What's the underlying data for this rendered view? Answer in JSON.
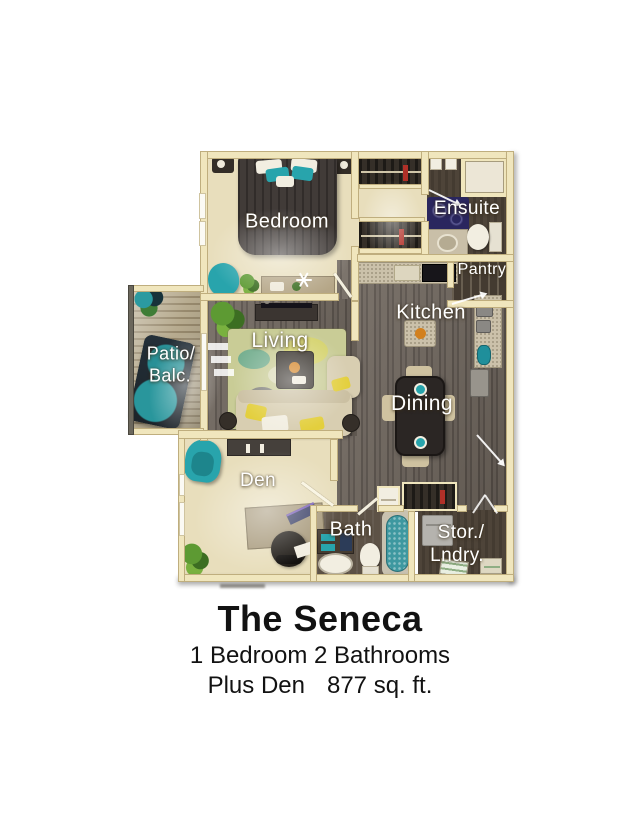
{
  "plan": {
    "name": "The Seneca",
    "subtitle": "1 Bedroom 2 Bathrooms",
    "details_left": "Plus Den",
    "details_right": "877 sq. ft.",
    "labels": {
      "bedroom": "Bedroom",
      "ensuite": "Ensuite",
      "pantry": "Pantry",
      "kitchen": "Kitchen",
      "living": "Living",
      "patio_line1": "Patio/",
      "patio_line2": "Balc.",
      "dining": "Dining",
      "den": "Den",
      "bath": "Bath",
      "stor_line1": "Stor./",
      "stor_line2": "Lndry."
    }
  },
  "colors": {
    "wall": "#f0e6bd",
    "wallEdge": "#bfae7e",
    "carpet": "#e8debc",
    "wood": "#6b625a",
    "darkFloor": "#4a4036",
    "deck": "#b3a68a",
    "teal": "#28a4ac",
    "sofa": "#d8ceb1",
    "bed": "#413b38",
    "granite": "#cbc1aa",
    "rug": "#c9cc96",
    "yellow": "#e3cf3d",
    "orange": "#d2801e",
    "navy": "#2a265e",
    "label": "#ffffff",
    "title": "#121212"
  }
}
